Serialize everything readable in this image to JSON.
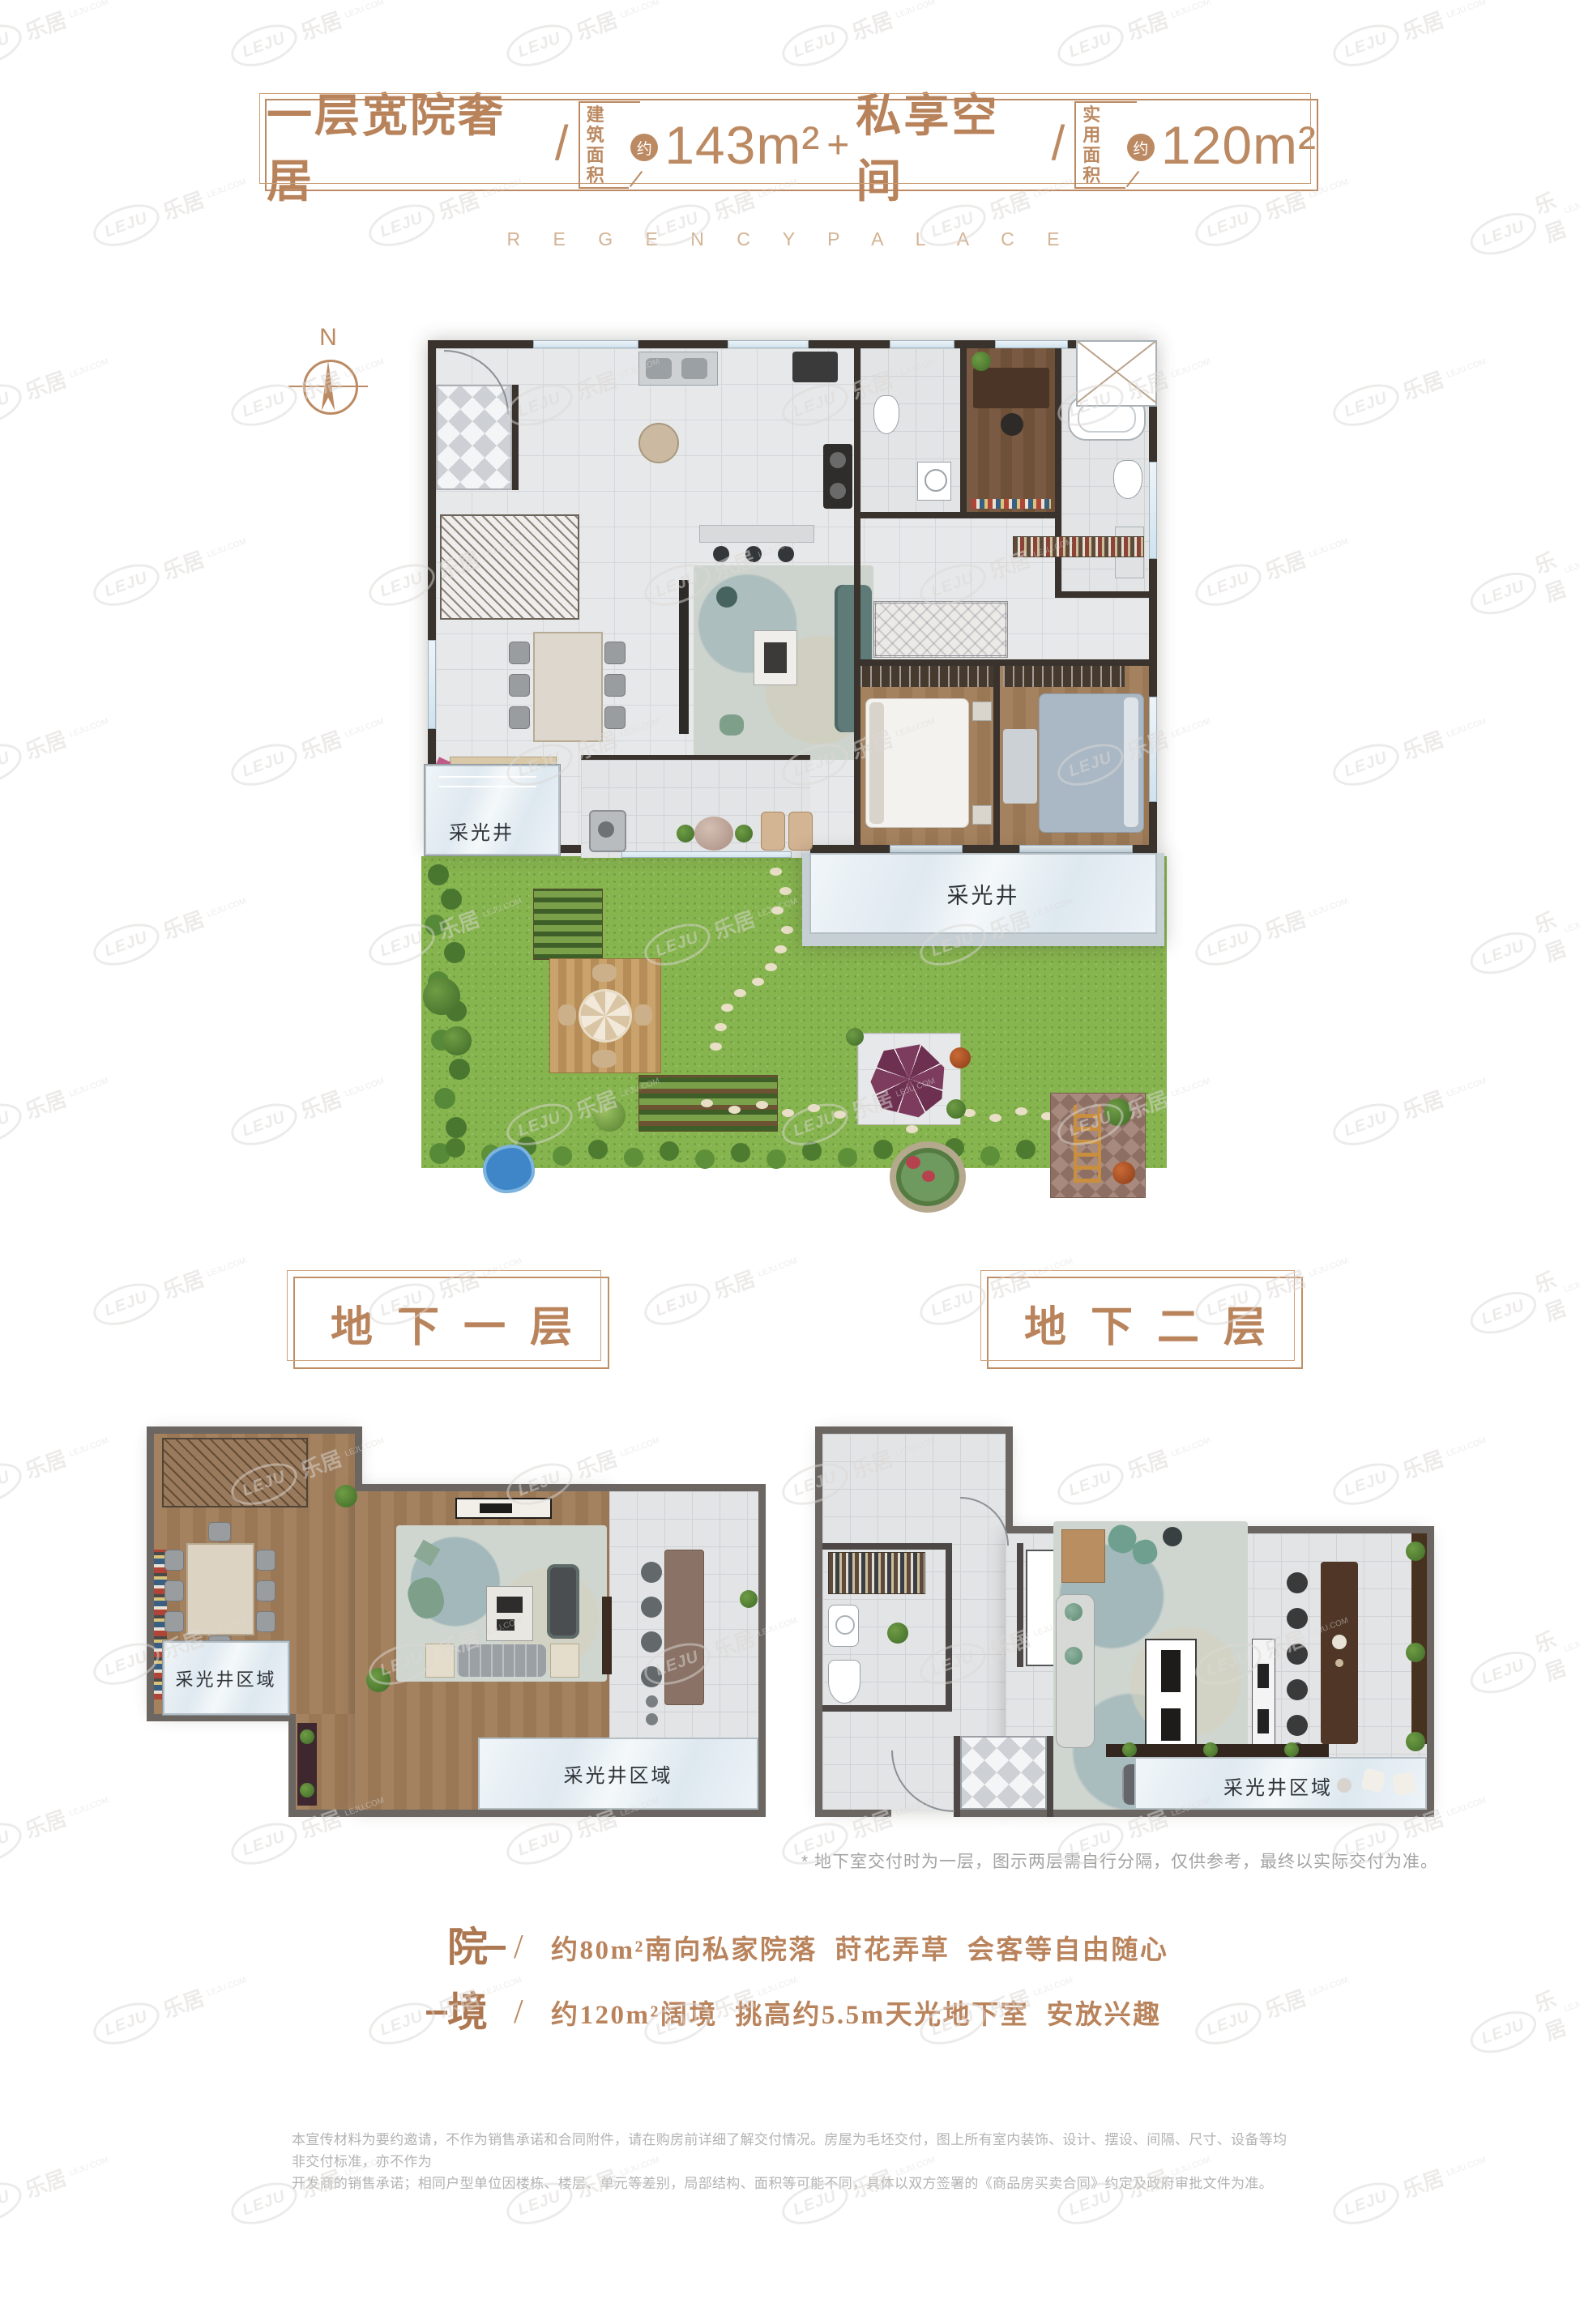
{
  "colors": {
    "accent": "#bc8a62",
    "accent_light": "#d3b394",
    "wall": "#3a332d",
    "grass": "#86b44e"
  },
  "watermark": {
    "logo": "LEJU",
    "cn": "乐居",
    "domain": "LEJU.COM"
  },
  "header": {
    "title": "一层宽院奢居",
    "slash": "/",
    "area1_label_l1": "建筑",
    "area1_label_l2": "面积",
    "area1_approx": "约",
    "area1_value": "143m²",
    "plus": "+",
    "title2": "私享空间",
    "area2_label_l1": "实用",
    "area2_label_l2": "面积",
    "area2_approx": "约",
    "area2_value": "120m²",
    "english": "R E G E N C Y   P A L A C E"
  },
  "compass": {
    "north": "N"
  },
  "first_floor": {
    "lightwell_left": "采光井",
    "lightwell_right": "采光井"
  },
  "basement1": {
    "title": "地下一层",
    "lightwell_left": "采光井区域",
    "lightwell_bottom": "采光井区域"
  },
  "basement2": {
    "title": "地下二层",
    "lightwell": "采光井区域"
  },
  "note": "* 地下室交付时为一层，图示两层需自行分隔，仅供参考，最终以实际交付为准。",
  "features": [
    {
      "big": "院",
      "dash": "—",
      "slash": "/",
      "text": "约80m²南向私家院落  莳花弄草  会客等自由随心"
    },
    {
      "big": "境",
      "dash": "—",
      "slash": "/",
      "text": "约120m²阔境  挑高约5.5m天光地下室  安放兴趣"
    }
  ],
  "disclaimer": {
    "line1": "本宣传材料为要约邀请，不作为销售承诺和合同附件，请在购房前详细了解交付情况。房屋为毛坯交付，图上所有室内装饰、设计、摆设、间隔、尺寸、设备等均非交付标准，亦不作为",
    "line2": "开发商的销售承诺；相同户型单位因楼栋、楼层、单元等差别，局部结构、面积等可能不同，具体以双方签署的《商品房买卖合同》约定及政府审批文件为准。"
  }
}
